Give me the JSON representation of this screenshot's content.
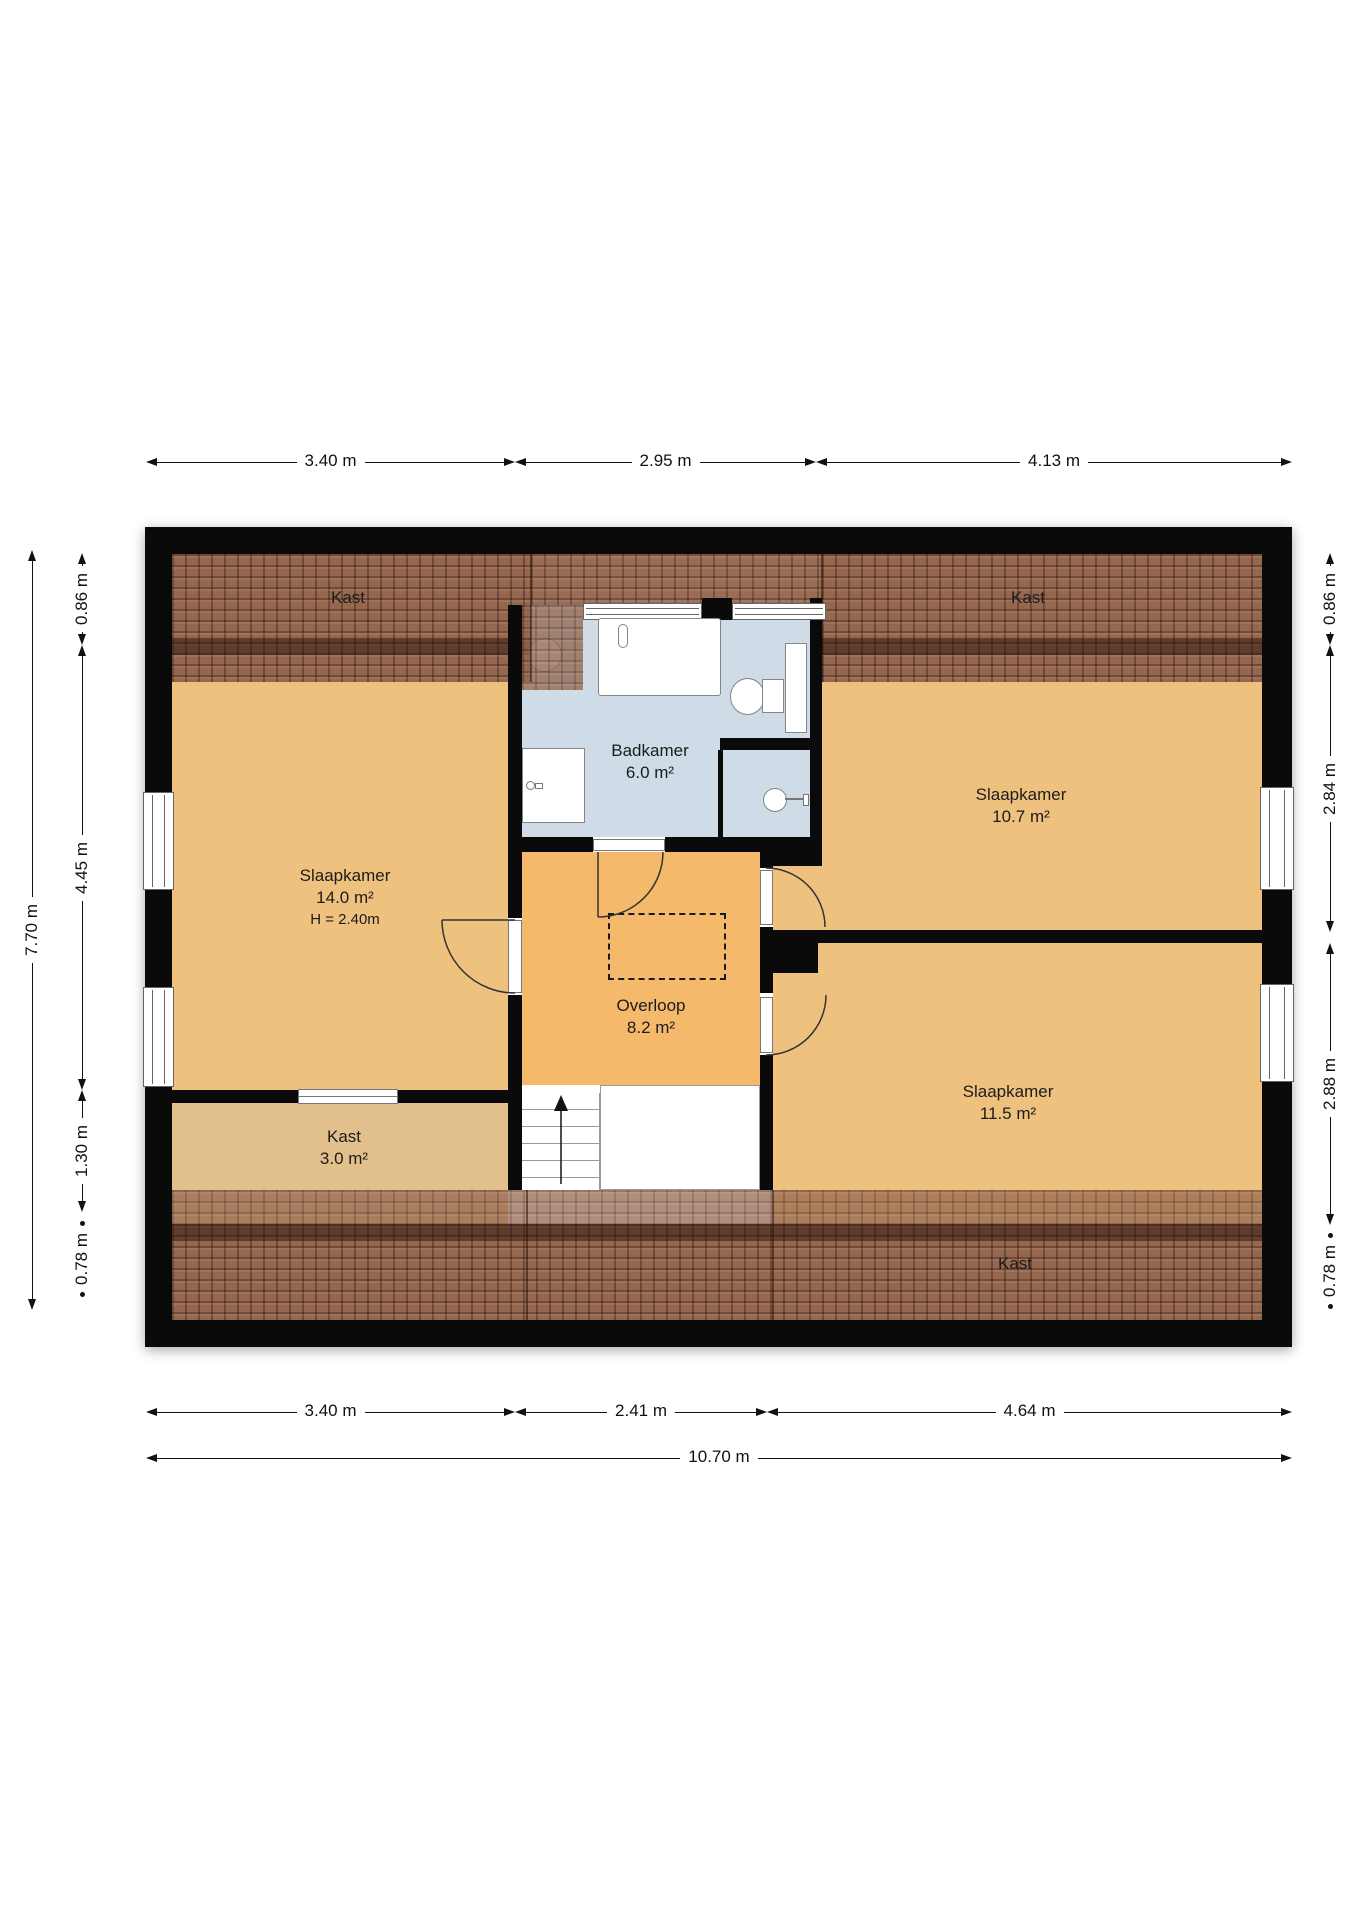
{
  "rooms": {
    "bedroom_left": {
      "name": "Slaapkamer",
      "area": "14.0 m²",
      "ceiling": "H = 2.40m"
    },
    "bathroom": {
      "name": "Badkamer",
      "area": "6.0 m²"
    },
    "bedroom_right_top": {
      "name": "Slaapkamer",
      "area": "10.7 m²"
    },
    "landing": {
      "name": "Overloop",
      "area": "8.2 m²"
    },
    "bedroom_right_bottom": {
      "name": "Slaapkamer",
      "area": "11.5 m²"
    },
    "closet_left": {
      "name": "Kast",
      "area": "3.0 m²"
    },
    "closet_top_left": {
      "name": "Kast"
    },
    "closet_top_right": {
      "name": "Kast"
    },
    "closet_bottom": {
      "name": "Kast"
    }
  },
  "dimensions": {
    "top": [
      "3.40 m",
      "2.95 m",
      "4.13 m"
    ],
    "bottom": [
      "3.40 m",
      "2.41 m",
      "4.64 m"
    ],
    "bottom_total": "10.70 m",
    "left": [
      "0.86 m",
      "4.45 m",
      "1.30 m",
      "0.78 m"
    ],
    "left_total": "7.70 m",
    "right": [
      "0.86 m",
      "2.84 m",
      "2.88 m",
      "0.78 m"
    ]
  },
  "colors": {
    "wall": "#0a0a0a",
    "bedroom": "#eec27e",
    "hallway": "#f5b96b",
    "closet": "#e2c08c",
    "bathroom": "#cfdce8",
    "roof": "#96674f",
    "roof_dark": "#5e4034",
    "text": "#222222"
  }
}
